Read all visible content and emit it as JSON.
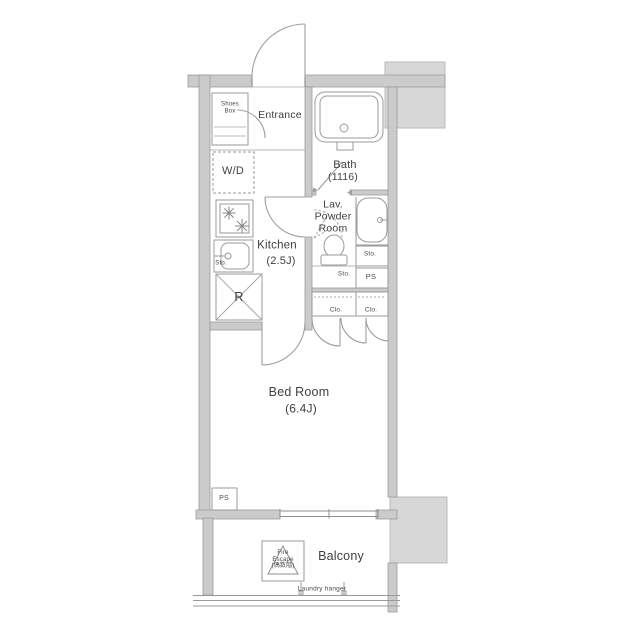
{
  "rooms": {
    "shoes_box": "Shoes\nBox",
    "entrance": "Entrance",
    "washer_dryer": "W/D",
    "bath": "Bath",
    "bath_size": "(1116)",
    "lav_powder_room": "Lav.\nPowder\nRoom",
    "kitchen": "Kitchen",
    "kitchen_size": "(2.5J)",
    "bedroom": "Bed Room",
    "bedroom_size": "(6.4J)",
    "balcony": "Balcony"
  },
  "labels": {
    "storage": "Sto.",
    "pipe_space": "PS",
    "closet": "Clo.",
    "refrigerator": "R",
    "fire_escape": "Fire\nEscape\n(偶数階)",
    "laundry_hanger": "Laundry hanger"
  },
  "icons": [
    "bathtub-icon",
    "toilet-icon",
    "washbasin-icon",
    "sink-icon",
    "stove-burner-icon",
    "door-swing-icon",
    "fire-escape-hatch-icon",
    "laundry-pole-icon",
    "refrigerator-cross-icon"
  ],
  "colors": {
    "wall_fill": "#cbcbcb",
    "neighbor_block": "#d7d7d7",
    "line": "#8f8f8f",
    "text": "#3f3f3f",
    "background": "#ffffff"
  }
}
